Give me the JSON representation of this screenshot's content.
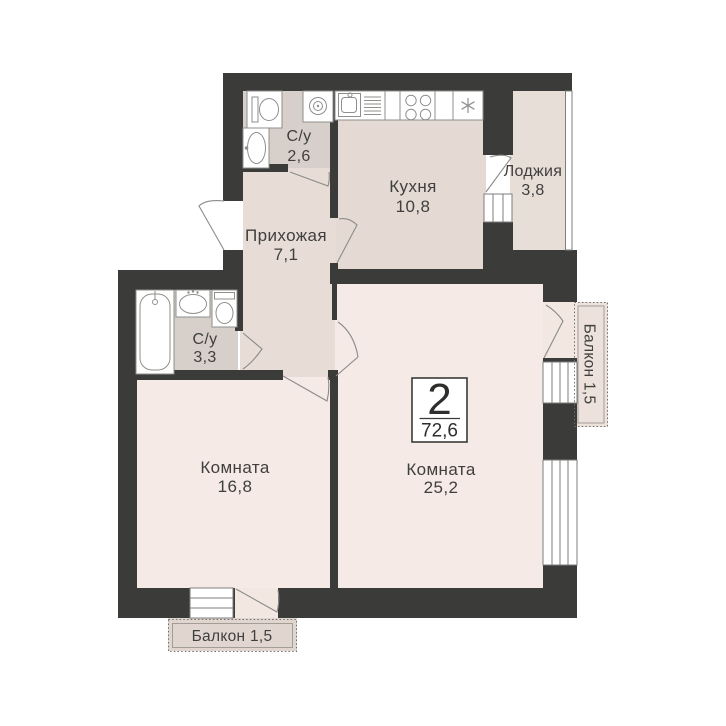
{
  "title": "2-room apartment floor plan",
  "badge": {
    "rooms_count": "2",
    "total_area": "72,6"
  },
  "rooms": {
    "bathroom_small": {
      "name": "С/у",
      "area": "2,6"
    },
    "kitchen": {
      "name": "Кухня",
      "area": "10,8"
    },
    "loggia": {
      "name": "Лоджия",
      "area": "3,8"
    },
    "hallway": {
      "name": "Прихожая",
      "area": "7,1"
    },
    "bathroom_big": {
      "name": "С/у",
      "area": "3,3"
    },
    "room_1": {
      "name": "Комната",
      "area": "16,8"
    },
    "room_2": {
      "name": "Комната",
      "area": "25,2"
    },
    "balcony_bottom": {
      "label": "Балкон 1,5"
    },
    "balcony_right": {
      "label": "Балкон 1,5"
    }
  },
  "icons": [
    "toilet-icon",
    "washing-machine-icon",
    "sink-icon",
    "kitchen-sink-icon",
    "stove-icon",
    "fridge-icon",
    "bathtub-icon"
  ],
  "colors": {
    "wall": "#3b3b39",
    "room": "#f5eae5",
    "hallway": "#e7dcd6",
    "kitchen": "#e4dad3",
    "bathroom": "#d7cfc9",
    "loggia": "#e7ded7",
    "balcony": "#e0d6cf",
    "text": "#3f3f3d",
    "background": "#ffffff"
  }
}
